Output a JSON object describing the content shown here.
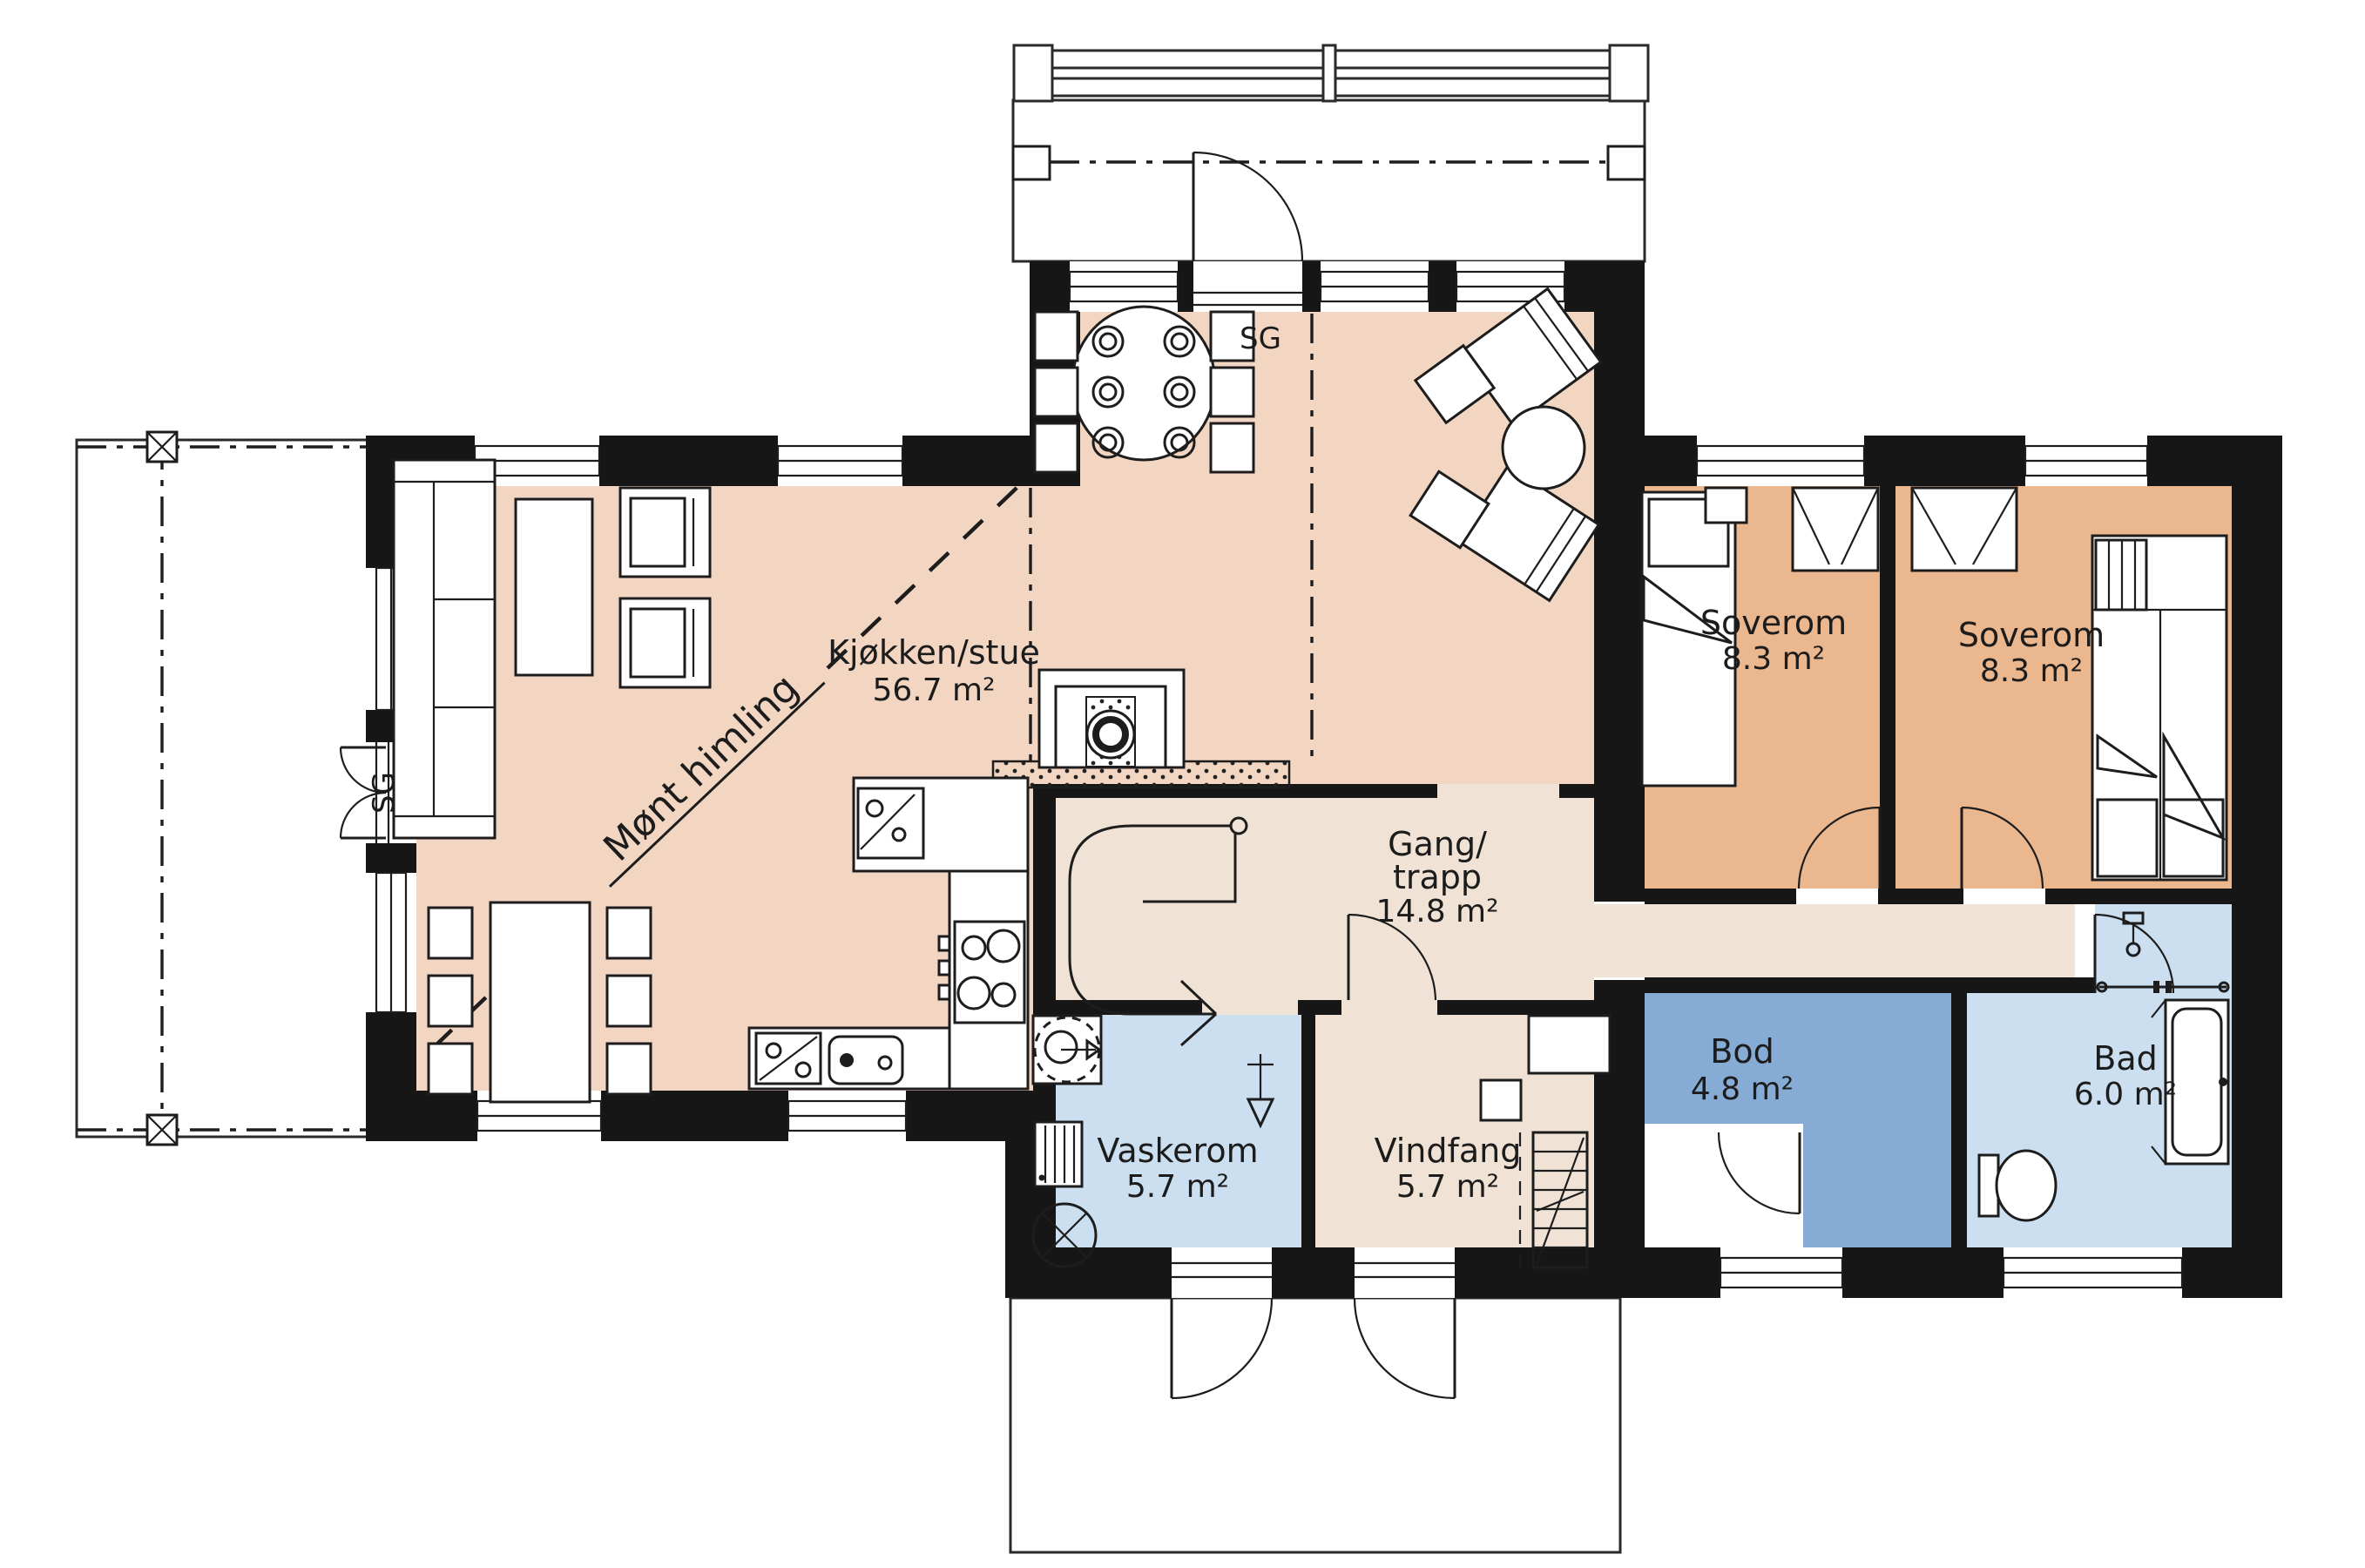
{
  "plan_title": "1. etasje plantegning",
  "rooms": {
    "kjokken_stue": {
      "name": "Kjøkken/stue",
      "area": "56.7 m²"
    },
    "gang_trapp": {
      "name_line1": "Gang/",
      "name_line2": "trapp",
      "area": "14.8 m²"
    },
    "soverom_1": {
      "name": "Soverom",
      "area": "8.3 m²"
    },
    "soverom_2": {
      "name": "Soverom",
      "area": "8.3 m²"
    },
    "bod": {
      "name": "Bod",
      "area": "4.8 m²"
    },
    "bad": {
      "name": "Bad",
      "area": "6.0 m²"
    },
    "vaskerom": {
      "name": "Vaskerom",
      "area": "5.7 m²"
    },
    "vindfang": {
      "name": "Vindfang",
      "area": "5.7 m²"
    }
  },
  "annotations": {
    "ceiling_note": "Mønt himling",
    "sg_top": "SG",
    "sg_left": "SG"
  },
  "colors": {
    "room_living": "#f2d6c2",
    "room_hall": "#f0e3d5",
    "room_bedroom": "#eab78f",
    "room_storage": "#86acd6",
    "room_wet": "#cbdff0",
    "wall": "#161616"
  }
}
